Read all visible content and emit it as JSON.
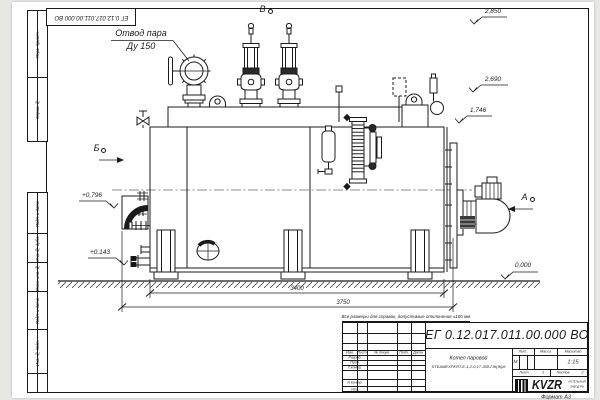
{
  "page": {
    "doc_number": "ЕГ 0.12.017.011.00.000  ВО",
    "note": "Все размеры для справок, допустимые отклонения ±100 мм",
    "format_label": "Формат А3"
  },
  "margin_stamps": {
    "s1": "Перв. примен.",
    "s2": "Справ. №",
    "s3": "Подп. и дата",
    "s4": "Инв. № дубл.",
    "s5": "Взам. инв. №",
    "s6": "Подп. и дата",
    "s7": "Инв. № подл."
  },
  "drawing": {
    "callout_line1": "Отвод пара",
    "callout_line2": "Ду 150",
    "view_labels": {
      "top": "В",
      "left": "Б",
      "right": "А"
    },
    "elevations": {
      "e2850": "2,850",
      "e2690": "2,690",
      "e1746": "1,746",
      "e0796": "+0,796",
      "e0143": "+0,143",
      "e0000": "0,000"
    },
    "dimensions": {
      "d3400": "3400",
      "d3750": "3750"
    }
  },
  "title_block": {
    "doc_number": "ЕГ 0.12.017.011.00.000  ВО",
    "product_name_line1": "Котел паровой",
    "product_name_line2": "STEAMEXPERT-E-1,2-0,17-350-ГЖ(Ж)И",
    "col_izm": "Изм.",
    "col_list": "Лист",
    "col_doc": "№ докум.",
    "col_podp": "Подп.",
    "col_data": "Дата",
    "row_razrab": "Разраб.",
    "row_prov": "Пров.",
    "row_tkontr": "Т.контр.",
    "row_nkontr": "Н.контр.",
    "row_utv": "Утв.",
    "litera_label": "Лит.",
    "massa_label": "Масса",
    "masshtab_label": "Масштаб",
    "litera_value": "М",
    "scale_value": "1:15",
    "sheet_label": "Лист",
    "sheet_value": "1",
    "sheets_label": "Листов",
    "sheets_value": "2",
    "logo_text": "KVZR",
    "logo_sub1": "КОТЕЛЬНЫЙ",
    "logo_sub2": "ЗАВОД РФ"
  },
  "colors": {
    "line": "#1b1b1b",
    "sheet": "#ffffff",
    "backdrop": "#e7e7e4"
  }
}
